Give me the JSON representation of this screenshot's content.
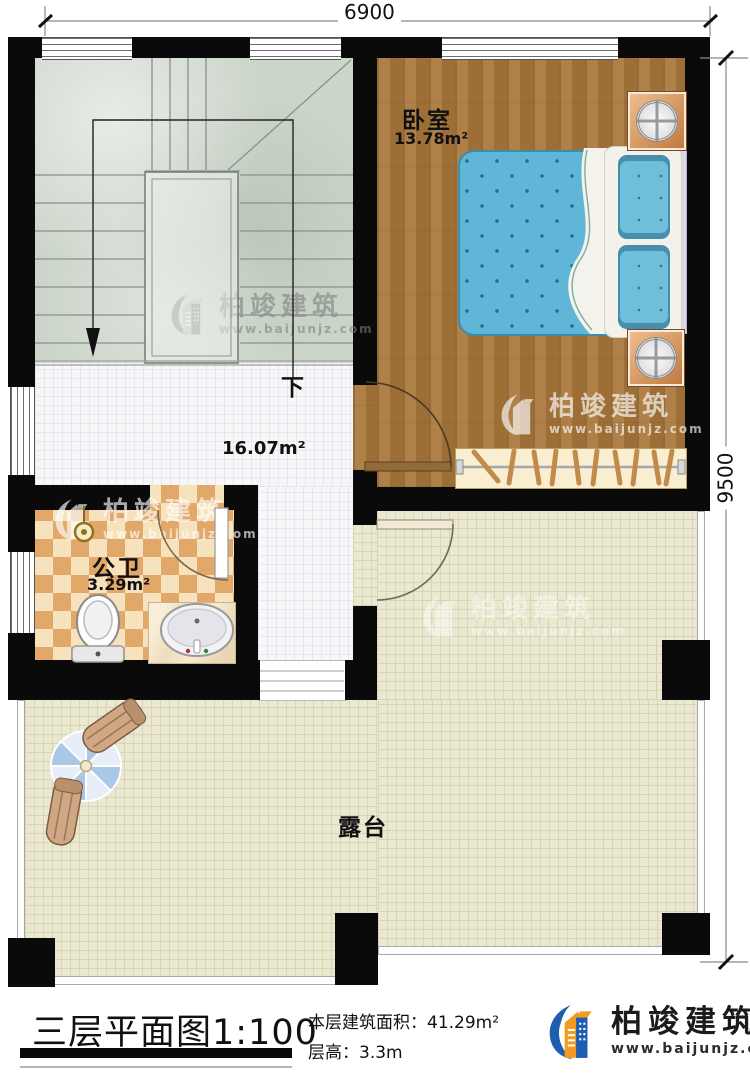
{
  "dimensions": {
    "top_width": "6900",
    "right_height": "9500"
  },
  "rooms": {
    "bedroom": {
      "name": "卧室",
      "area": "13.78m²"
    },
    "hall": {
      "area": "16.07m²"
    },
    "bathroom": {
      "name": "公卫",
      "area": "3.29m²"
    },
    "terrace": {
      "name": "露台"
    },
    "stairs": {
      "direction_label": "下"
    }
  },
  "footer": {
    "title": "三层平面图1:100",
    "area_label": "本层建筑面积：",
    "area_value": "41.29m²",
    "height_label": "层高：",
    "height_value": "3.3m"
  },
  "brand": {
    "name": "柏竣建筑",
    "website": "www.baijunjz.com"
  },
  "watermark": {
    "name": "柏竣建筑",
    "website": "www.baijunjz.com"
  },
  "colors": {
    "wall": "#0a0a0a",
    "bed_blue": "#5fb6d7",
    "wood": "#a9763a",
    "terrace_tile": "#ebe8d0",
    "bath_tile": "#e2a869",
    "stair_floor": "#ccd5ca",
    "brand_blue": "#1d5fae",
    "brand_orange": "#f49a1e"
  }
}
